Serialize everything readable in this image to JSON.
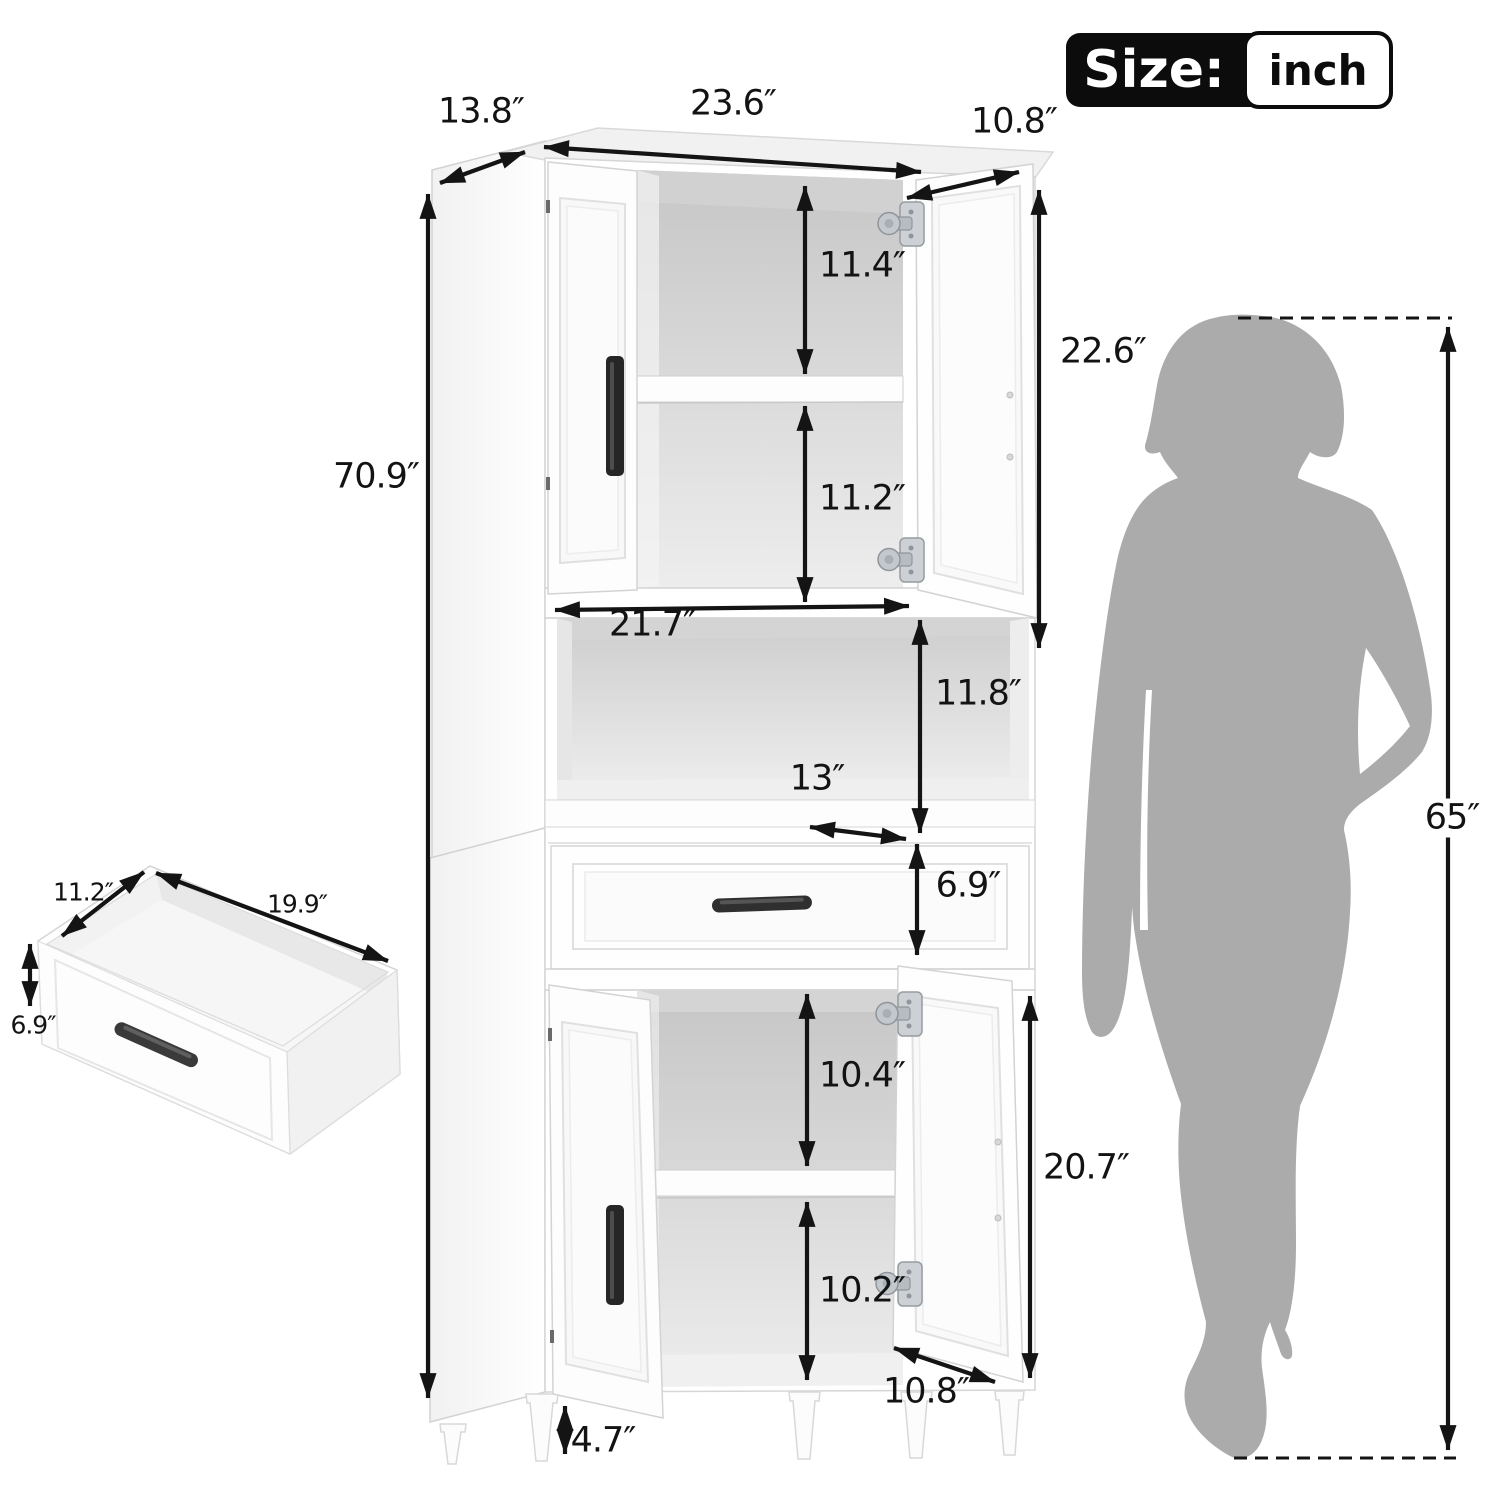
{
  "size_badge": {
    "label": "Size:",
    "unit": "inch"
  },
  "cabinet_dimensions": {
    "top_depth": "13.8″",
    "top_width": "23.6″",
    "top_door_width": "10.8″",
    "upper_shelf_space": "11.4″",
    "upper_door_height": "22.6″",
    "total_height": "70.9″",
    "upper_lower_space": "11.2″",
    "open_shelf_width": "21.7″",
    "open_shelf_height": "11.8″",
    "open_shelf_depth": "13″",
    "drawer_height": "6.9″",
    "lower_upper_space": "10.4″",
    "lower_door_height": "20.7″",
    "lower_lower_space": "10.2″",
    "lower_door_width": "10.8″",
    "leg_height": "4.7″"
  },
  "drawer_detail": {
    "depth": "11.2″",
    "width": "19.9″",
    "height": "6.9″"
  },
  "person": {
    "height": "65″"
  },
  "colors": {
    "silhouette": "#ababab",
    "dimension_text": "#131313",
    "badge_black": "#0c0c0c"
  }
}
